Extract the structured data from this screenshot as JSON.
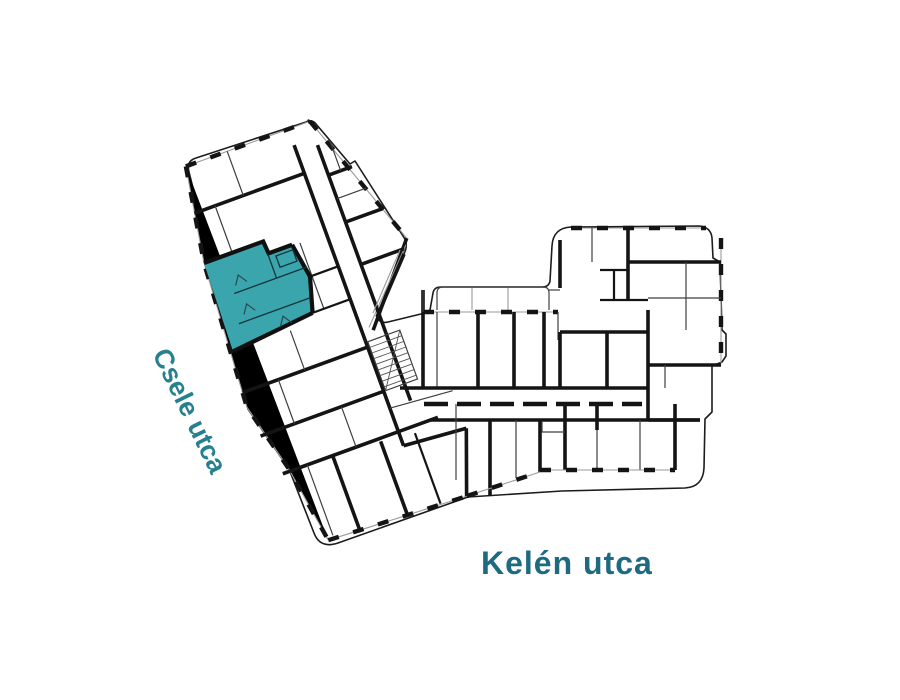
{
  "plan": {
    "type": "building-floor-plan",
    "selected_unit": {
      "fill_color": "#3aa5ad"
    },
    "streets": {
      "left": {
        "label": "Csele utca",
        "color": "#27808e"
      },
      "bottom": {
        "label": "Kelén utca",
        "color": "#1e6a80"
      }
    },
    "colors": {
      "walls": "#141414",
      "outline": "#1c1c1c",
      "doors": "#c6c6c6",
      "background": "#ffffff"
    }
  }
}
